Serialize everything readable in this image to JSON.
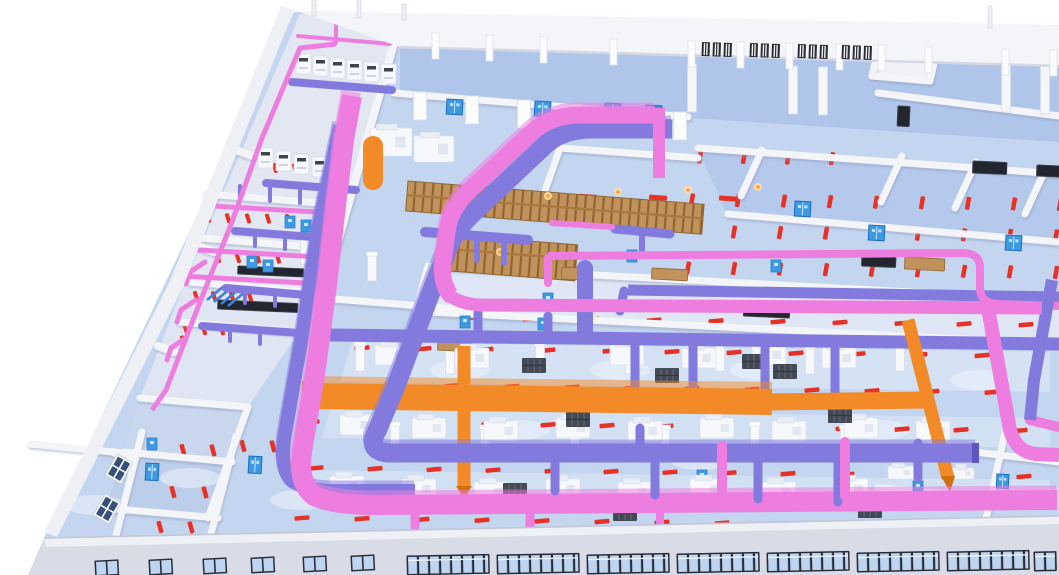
{
  "scene_type": "isometric-3d-bim-mep-factory-model",
  "palette": {
    "bg": "#ffffff",
    "pink": "#ee7de0",
    "pink_light": "#f9abee",
    "pink_deep": "#c94fb4",
    "purple": "#837ade",
    "purple_light": "#aaa1f0",
    "purple_deep": "#6054c0",
    "orange": "#f28a28",
    "orange_deep": "#d06f10",
    "red": "#e63226",
    "wall": "#f4f5f9",
    "wall_shadow": "#d7dae6",
    "floor": "#c3d5ef",
    "floor_deep": "#afc6ea",
    "floor_pale": "#dce7f7",
    "floor_room": "#a9c1e7",
    "facade": "#d9dce7",
    "facade_light": "#eef0f6",
    "glass": "#bdd5f0",
    "frame": "#2a2d38",
    "door_blue": "#3d9ae2",
    "door_blue_deep": "#1f6dbd",
    "tan": "#c2925c",
    "tan_dark": "#8f6632",
    "dark": "#3e434d",
    "white": "#f7f8fb"
  },
  "walls": [
    [
      394,
      93,
      688,
      117
    ],
    [
      878,
      93,
      1059,
      116
    ],
    [
      402,
      15,
      322,
      298,
      8
    ],
    [
      428,
      266,
      1059,
      300
    ],
    [
      430,
      312,
      1059,
      344
    ],
    [
      428,
      266,
      416,
      310
    ],
    [
      698,
      148,
      1059,
      174
    ],
    [
      762,
      150,
      741,
      196
    ],
    [
      902,
      156,
      881,
      202
    ],
    [
      976,
      162,
      955,
      208
    ],
    [
      1046,
      168,
      1025,
      214
    ],
    [
      728,
      214,
      1059,
      242
    ],
    [
      560,
      148,
      698,
      158
    ],
    [
      560,
      148,
      541,
      202
    ],
    [
      541,
      202,
      678,
      213
    ],
    [
      884,
      24,
      942,
      28
    ],
    [
      884,
      24,
      872,
      76
    ],
    [
      872,
      76,
      930,
      81
    ],
    [
      942,
      28,
      930,
      81
    ],
    [
      140,
      398,
      248,
      407
    ],
    [
      124,
      452,
      232,
      462
    ],
    [
      106,
      508,
      218,
      518
    ],
    [
      248,
      407,
      228,
      462
    ],
    [
      228,
      462,
      208,
      518
    ],
    [
      30,
      444,
      124,
      453
    ],
    [
      142,
      432,
      116,
      536
    ],
    [
      236,
      436,
      210,
      538
    ],
    [
      206,
      194,
      332,
      204
    ],
    [
      200,
      238,
      322,
      248
    ],
    [
      190,
      282,
      310,
      292
    ],
    [
      180,
      322,
      300,
      332
    ],
    [
      322,
      298,
      470,
      310
    ],
    [
      878,
      488,
      1006,
      498
    ],
    [
      1006,
      428,
      984,
      528
    ],
    [
      974,
      452,
      1059,
      462
    ],
    [
      236,
      150,
      252,
      156,
      8
    ],
    [
      198,
      246,
      214,
      252,
      8
    ],
    [
      158,
      346,
      174,
      352,
      8
    ],
    [
      113,
      452,
      129,
      458,
      8
    ]
  ],
  "marker_rows": [
    [
      468,
      318,
      10,
      62,
      15,
      4.5,
      -5
    ],
    [
      362,
      348,
      11,
      62,
      15,
      4.5,
      -5
    ],
    [
      392,
      385,
      11,
      60,
      15,
      4.5,
      -5
    ],
    [
      312,
      422,
      13,
      59,
      15,
      4.5,
      -5
    ],
    [
      316,
      468,
      13,
      59,
      15,
      4.5,
      -5
    ],
    [
      302,
      518,
      13,
      60,
      15,
      4.5,
      -5
    ],
    [
      598,
      543,
      6,
      78,
      15,
      4.5,
      -5
    ],
    [
      700,
      157,
      4,
      44,
      4.5,
      13,
      10
    ],
    [
      692,
      200,
      9,
      46,
      4.5,
      13,
      10
    ],
    [
      734,
      232,
      8,
      46,
      4.5,
      13,
      10
    ],
    [
      688,
      268,
      9,
      46,
      4.5,
      13,
      10
    ],
    [
      518,
      196,
      4,
      70,
      18,
      5,
      4
    ],
    [
      465,
      247,
      2,
      60,
      18,
      5,
      4
    ],
    [
      183,
      450,
      2,
      30,
      4.5,
      12,
      -15
    ],
    [
      173,
      492,
      2,
      32,
      4.5,
      12,
      -15
    ],
    [
      160,
      527,
      2,
      31,
      4.5,
      12,
      -15
    ],
    [
      243,
      446,
      2,
      30,
      4.5,
      12,
      -15
    ],
    [
      275,
      168,
      4,
      20,
      4,
      10,
      -18
    ],
    [
      208,
      218,
      5,
      20,
      4,
      10,
      -18
    ],
    [
      218,
      258,
      4,
      20,
      4,
      10,
      -18
    ],
    [
      196,
      296,
      4,
      18,
      4,
      10,
      -18
    ],
    [
      186,
      330,
      3,
      18,
      4,
      10,
      -18
    ],
    [
      150,
      340,
      2,
      33,
      4,
      10,
      -18
    ]
  ],
  "pipes": [
    [
      266,
      183,
      356,
      190,
      8,
      "u"
    ],
    [
      213,
      206,
      333,
      213,
      5,
      "p"
    ],
    [
      235,
      231,
      325,
      238,
      8,
      "u"
    ],
    [
      199,
      250,
      319,
      257,
      5,
      "p"
    ],
    [
      181,
      276,
      305,
      283,
      5,
      "p"
    ],
    [
      226,
      288,
      306,
      295,
      8,
      "u"
    ],
    [
      202,
      326,
      300,
      333,
      8,
      "u"
    ],
    [
      240,
      186,
      240,
      199,
      4,
      "u"
    ],
    [
      270,
      188,
      270,
      201,
      4,
      "u"
    ],
    [
      300,
      190,
      300,
      203,
      4,
      "u"
    ],
    [
      255,
      233,
      255,
      246,
      4,
      "u"
    ],
    [
      285,
      236,
      285,
      249,
      4,
      "u"
    ],
    [
      245,
      290,
      245,
      303,
      4,
      "u"
    ],
    [
      275,
      293,
      275,
      306,
      4,
      "u"
    ],
    [
      230,
      328,
      230,
      341,
      4,
      "u"
    ],
    [
      260,
      331,
      260,
      344,
      4,
      "u"
    ],
    [
      205,
      262,
      190,
      272,
      5,
      "p"
    ],
    [
      190,
      272,
      186,
      284,
      5,
      "p"
    ],
    [
      196,
      300,
      181,
      310,
      5,
      "p"
    ],
    [
      181,
      310,
      177,
      322,
      5,
      "p"
    ],
    [
      186,
      338,
      171,
      348,
      5,
      "p"
    ],
    [
      171,
      348,
      167,
      360,
      5,
      "p"
    ],
    [
      292,
      82,
      392,
      90,
      8,
      "u"
    ],
    [
      298,
      36,
      390,
      44,
      4,
      "p"
    ],
    [
      336,
      20,
      336,
      43,
      4,
      "p"
    ],
    [
      425,
      232,
      528,
      240,
      10,
      "u"
    ],
    [
      450,
      236,
      450,
      257,
      6,
      "u"
    ],
    [
      477,
      239,
      477,
      260,
      6,
      "u"
    ],
    [
      504,
      242,
      504,
      263,
      6,
      "u"
    ],
    [
      615,
      229,
      670,
      234,
      9,
      "u"
    ],
    [
      642,
      232,
      642,
      253,
      6,
      "u"
    ],
    [
      552,
      223,
      612,
      227,
      6,
      "p"
    ],
    [
      585,
      268,
      585,
      333,
      16,
      "u"
    ],
    [
      635,
      340,
      635,
      386,
      9,
      "u"
    ],
    [
      693,
      343,
      693,
      389,
      9,
      "u"
    ],
    [
      765,
      346,
      765,
      392,
      9,
      "u"
    ],
    [
      835,
      349,
      835,
      394,
      9,
      "u"
    ],
    [
      478,
      313,
      478,
      333,
      9,
      "u"
    ],
    [
      548,
      316,
      548,
      336,
      9,
      "u"
    ],
    [
      624,
      291,
      620,
      311,
      9,
      "u"
    ],
    [
      548,
      258,
      548,
      283,
      8,
      "p"
    ],
    [
      373,
      146,
      373,
      180,
      20,
      "o"
    ],
    [
      1030,
      420,
      1059,
      427,
      10,
      "p"
    ]
  ],
  "pipes_front": [
    [
      555,
      455,
      555,
      491,
      9,
      "u"
    ],
    [
      655,
      458,
      655,
      495,
      9,
      "u"
    ],
    [
      758,
      461,
      758,
      499,
      9,
      "u"
    ],
    [
      838,
      463,
      838,
      502,
      9,
      "u"
    ],
    [
      640,
      428,
      640,
      450,
      9,
      "u"
    ],
    [
      918,
      443,
      918,
      478,
      9,
      "u"
    ],
    [
      722,
      446,
      722,
      498,
      10,
      "p"
    ],
    [
      845,
      442,
      845,
      496,
      10,
      "p"
    ],
    [
      530,
      507,
      530,
      527,
      9,
      "p"
    ],
    [
      415,
      508,
      415,
      527,
      9,
      "p"
    ],
    [
      660,
      506,
      660,
      523,
      8,
      "p"
    ]
  ],
  "machines": [
    [
      375,
      345
    ],
    [
      455,
      348
    ],
    [
      610,
      345
    ],
    [
      682,
      348
    ],
    [
      752,
      345
    ],
    [
      822,
      348
    ],
    [
      340,
      415
    ],
    [
      412,
      418
    ],
    [
      484,
      421
    ],
    [
      556,
      418
    ],
    [
      628,
      421
    ],
    [
      700,
      418
    ],
    [
      772,
      421
    ],
    [
      844,
      418
    ],
    [
      916,
      421
    ],
    [
      330,
      476
    ],
    [
      402,
      479
    ],
    [
      474,
      482
    ],
    [
      546,
      479
    ],
    [
      618,
      482
    ],
    [
      690,
      479
    ],
    [
      762,
      482
    ],
    [
      834,
      479
    ],
    [
      888,
      466,
      26,
      13
    ],
    [
      926,
      443,
      26,
      13
    ],
    [
      952,
      468,
      22,
      11
    ],
    [
      370,
      128,
      42,
      28
    ],
    [
      414,
      136,
      40,
      26
    ]
  ],
  "ahus": [
    [
      296,
      54
    ],
    [
      313,
      56
    ],
    [
      330,
      58
    ],
    [
      347,
      60
    ],
    [
      364,
      62
    ],
    [
      381,
      64
    ],
    [
      258,
      148
    ],
    [
      276,
      151
    ],
    [
      294,
      154
    ],
    [
      312,
      157
    ]
  ],
  "pallets": [
    [
      522,
      358
    ],
    [
      566,
      412
    ],
    [
      655,
      368
    ],
    [
      742,
      354
    ],
    [
      773,
      364
    ],
    [
      828,
      408
    ],
    [
      748,
      523
    ],
    [
      858,
      503
    ],
    [
      503,
      483
    ],
    [
      613,
      506
    ]
  ],
  "racks": [
    [
      408,
      181,
      297,
      30,
      4.5
    ],
    [
      452,
      235,
      126,
      36,
      4.5
    ]
  ],
  "lamps": [
    [
      548,
      196
    ],
    [
      618,
      192
    ],
    [
      688,
      190
    ],
    [
      758,
      187
    ],
    [
      500,
      252
    ]
  ],
  "desks": [
    [
      562,
      267,
      30,
      12
    ],
    [
      905,
      257,
      40,
      12
    ],
    [
      652,
      268,
      36,
      11
    ],
    [
      438,
      340,
      34,
      10
    ]
  ],
  "screens": [
    [
      862,
      255,
      34,
      11
    ],
    [
      973,
      161,
      34,
      12
    ],
    [
      1037,
      165,
      26,
      11
    ],
    [
      238,
      266,
      66,
      8
    ],
    [
      218,
      300,
      80,
      9
    ],
    [
      744,
      303,
      46,
      13
    ],
    [
      898,
      106,
      12,
      20
    ]
  ],
  "doors": [
    [
      447,
      99
    ],
    [
      535,
      101
    ],
    [
      605,
      103
    ],
    [
      646,
      105
    ],
    [
      795,
      201
    ],
    [
      869,
      225
    ],
    [
      1006,
      235
    ],
    [
      146,
      463,
      13,
      17
    ],
    [
      249,
      456,
      13,
      17
    ],
    [
      997,
      474,
      12,
      14
    ]
  ],
  "panels": [
    [
      285,
      216
    ],
    [
      301,
      220
    ],
    [
      317,
      224
    ],
    [
      247,
      256
    ],
    [
      263,
      260
    ],
    [
      543,
      293
    ],
    [
      460,
      316
    ],
    [
      627,
      250
    ],
    [
      771,
      260
    ],
    [
      697,
      470
    ],
    [
      913,
      481
    ],
    [
      538,
      318
    ],
    [
      147,
      438
    ]
  ],
  "columns": [
    [
      360,
      345
    ],
    [
      450,
      348
    ],
    [
      540,
      345
    ],
    [
      630,
      348
    ],
    [
      720,
      345
    ],
    [
      810,
      348
    ],
    [
      900,
      345
    ],
    [
      395,
      425
    ],
    [
      485,
      428
    ],
    [
      575,
      425
    ],
    [
      665,
      428
    ],
    [
      755,
      425
    ],
    [
      845,
      428
    ],
    [
      935,
      425
    ],
    [
      305,
      238
    ],
    [
      372,
      255
    ]
  ],
  "pillars": [
    [
      420,
      92
    ],
    [
      472,
      96
    ],
    [
      524,
      100
    ],
    [
      576,
      104
    ],
    [
      628,
      108
    ],
    [
      680,
      112
    ]
  ],
  "bigcols": [
    [
      692,
      64
    ],
    [
      793,
      66
    ],
    [
      823,
      67
    ],
    [
      1006,
      64
    ],
    [
      1045,
      66
    ]
  ],
  "posts": [
    [
      312,
      0,
      16
    ],
    [
      357,
      0,
      18
    ],
    [
      402,
      4,
      16
    ],
    [
      988,
      6,
      22
    ]
  ],
  "pilasters": [
    [
      432,
      33
    ],
    [
      486,
      35
    ],
    [
      540,
      37
    ],
    [
      610,
      39
    ],
    [
      688,
      41
    ],
    [
      737,
      42
    ],
    [
      786,
      43
    ],
    [
      836,
      44
    ],
    [
      878,
      45
    ],
    [
      925,
      47
    ],
    [
      1002,
      49
    ],
    [
      1050,
      50
    ]
  ],
  "top_windows": [
    [
      702,
      42
    ],
    [
      750,
      43
    ],
    [
      798,
      44
    ],
    [
      842,
      45
    ]
  ],
  "ribbons": [
    [
      408,
      557
    ],
    [
      498,
      556
    ],
    [
      588,
      556
    ],
    [
      678,
      555
    ],
    [
      768,
      554
    ],
    [
      858,
      554
    ],
    [
      948,
      553
    ],
    [
      1035,
      553,
      20
    ]
  ],
  "small_windows": [
    [
      96,
      562
    ],
    [
      150,
      561
    ],
    [
      204,
      560
    ],
    [
      252,
      559
    ],
    [
      304,
      558
    ],
    [
      352,
      557
    ]
  ],
  "wall_windows": [
    [
      108,
      474
    ],
    [
      96,
      514
    ]
  ],
  "glows": [
    [
      95,
      505
    ],
    [
      190,
      478
    ],
    [
      520,
      430
    ],
    [
      700,
      460
    ],
    [
      880,
      430
    ],
    [
      460,
      370
    ],
    [
      760,
      370
    ],
    [
      980,
      380
    ],
    [
      300,
      500
    ],
    [
      620,
      370
    ]
  ]
}
